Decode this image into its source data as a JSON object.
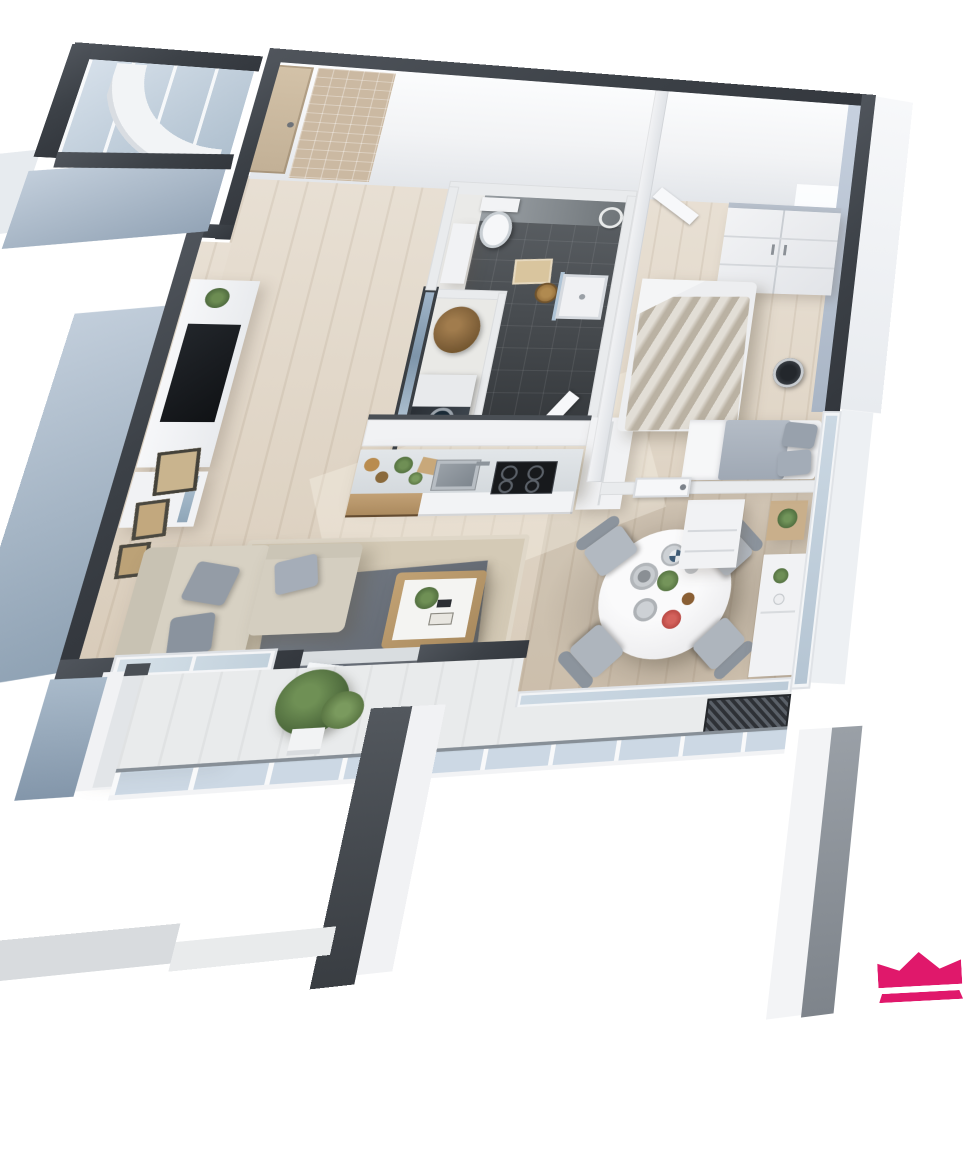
{
  "scene": {
    "title": "3D apartment floor plan render",
    "projection": "birds-eye perspective",
    "background": "#ffffff"
  },
  "branding": {
    "logo": "crown-logo",
    "color": "#E0186B"
  },
  "palette": {
    "wall_cap": "#3F444B",
    "exterior_wall_face": "#AEBDCB",
    "interior_wall": "#E9EBED",
    "wood_floor": "#E0D5C5",
    "wood_floor_dark": "#C9BCAC",
    "bathroom_tile": "#4A4F54",
    "glass": "#C6D3E0",
    "kitchen_wood": "#B7976C",
    "sofa_beige": "#D7D1C3",
    "textile_gray": "#A9B1BC",
    "plant_green": "#5F7F4D",
    "logo_pink": "#E0186B"
  },
  "rooms": {
    "entry_hall": {
      "label": "Entry hall",
      "items": {
        "entry_door": "Entry door",
        "tiled_wall": "Tiled accent wall",
        "porch": "Glazed corner porch",
        "shower_screen": "Curved glass screen"
      }
    },
    "bathroom": {
      "label": "Bathroom",
      "items": {
        "toilet": "Toilet",
        "shower_tray": "Shower tray",
        "bath_mat": "Bath mat",
        "basket": "Wicker basket",
        "towel_ring": "Towel ring",
        "vanity": "Vanity unit",
        "door": "Bathroom door",
        "partition": "Glazed partition"
      }
    },
    "utility": {
      "label": "Utility closet",
      "items": {
        "washing_machine": "Washing machine",
        "storage_basket": "Storage basket"
      }
    },
    "kitchen": {
      "label": "Kitchen",
      "items": {
        "counter": "Kitchen counter",
        "drawers": "Wood drawer unit",
        "sink": "Sink",
        "faucet": "Faucet",
        "cooktop": "Cooktop",
        "upper_cabinets": "Cabinet run",
        "tall_cabinet": "Tall cabinet",
        "decor": "Counter decor"
      }
    },
    "living_room": {
      "label": "Living room",
      "items": {
        "sofa": "Corner sofa",
        "pillows": "Pillows",
        "rug": "Area rug",
        "runner": "Gray rug",
        "coffee_table": "Coffee table",
        "tv_unit": "TV wall unit",
        "tv": "TV",
        "lowboard": "Lowboard",
        "frames": "Wall frames",
        "window": "Window",
        "balcony_door": "Open balcony door"
      }
    },
    "dining_area": {
      "label": "Dining area",
      "items": {
        "table": "Round dining table",
        "chairs": "Dining chairs",
        "chair_count": "4",
        "tableware": "Tableware",
        "sideboard": "Sideboard",
        "dresser": "Dresser",
        "plant_table": "Plant table"
      }
    },
    "bedroom": {
      "label": "Bedroom",
      "items": {
        "wardrobe": "Wardrobe",
        "bed_main": "Double bed",
        "bed_second": "Day bed",
        "pillows": "Pillows",
        "round_rug": "Round decor plate",
        "door_closed": "Bedroom door",
        "door_open": "Open door",
        "window": "Window band"
      }
    },
    "balcony": {
      "label": "Balcony",
      "items": {
        "railing": "Glass railing",
        "handrail": "Metal handrail",
        "plant": "Potted plant",
        "grate": "Drain grate"
      }
    }
  }
}
